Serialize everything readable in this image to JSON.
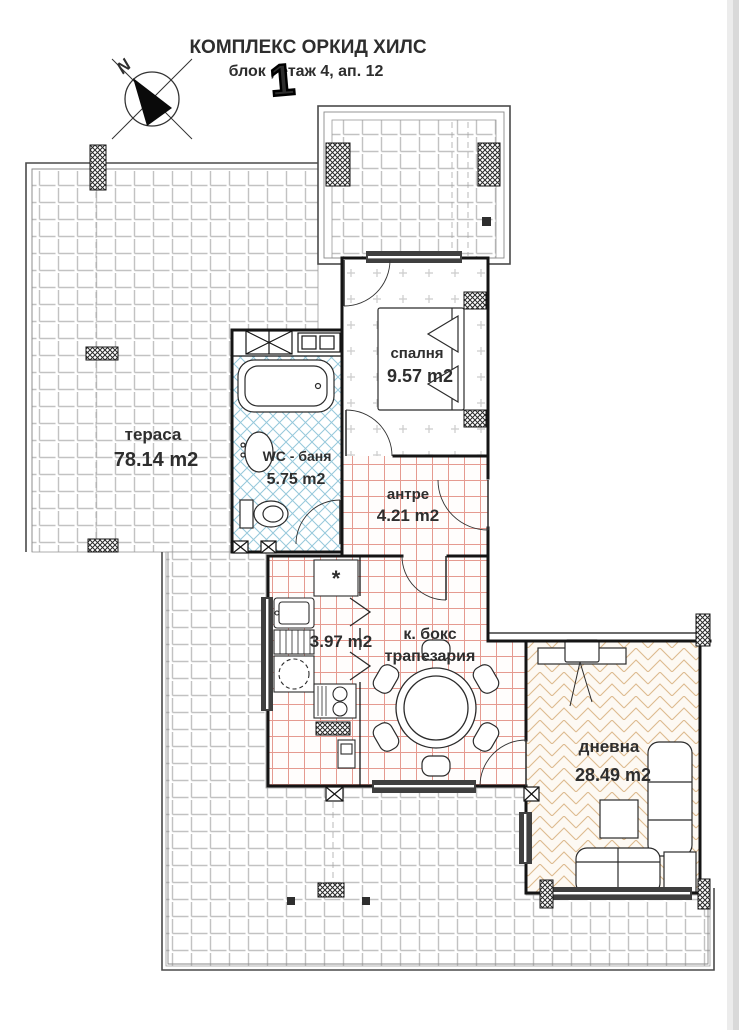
{
  "header": {
    "title": "КОМПЛЕКС ОРКИД ХИЛС",
    "subtitle": "блок  , етаж 4, ап. 12",
    "block_overwrite": "1",
    "compass_label": "N"
  },
  "rooms": {
    "terrace": {
      "name": "тераса",
      "area": "78.14 m2"
    },
    "bedroom": {
      "name": "спалня",
      "area": "9.57 m2"
    },
    "bathroom": {
      "name": "WC - баня",
      "area": "5.75 m2"
    },
    "hallway": {
      "name": "антре",
      "area": "4.21 m2"
    },
    "kitchen": {
      "area": "3.97 m2",
      "freezer_symbol": "*"
    },
    "dining": {
      "name_line1": "к. бокс",
      "name_line2": "трапезария"
    },
    "living": {
      "name": "дневна",
      "area": "28.49 m2"
    }
  },
  "palette": {
    "walls": "#141414",
    "terrace_tile_line": "#c2c2c2",
    "bathroom_tile": "#96c8db",
    "hall_kitchen_tile": "#e59a90",
    "living_parquet": "#ddba8f",
    "window_fill": "#3f3f3f",
    "page_edge": "#d9d9d9"
  },
  "fixtures": [
    "bed",
    "nightstand",
    "bathtub",
    "washbasin",
    "toilet",
    "fridge",
    "kitchen-sink",
    "dishwasher",
    "washing-machine",
    "stove",
    "dining-table",
    "chair",
    "tv-cabinet",
    "tv",
    "corner-sofa",
    "sofa",
    "armchair",
    "coffee-table"
  ]
}
